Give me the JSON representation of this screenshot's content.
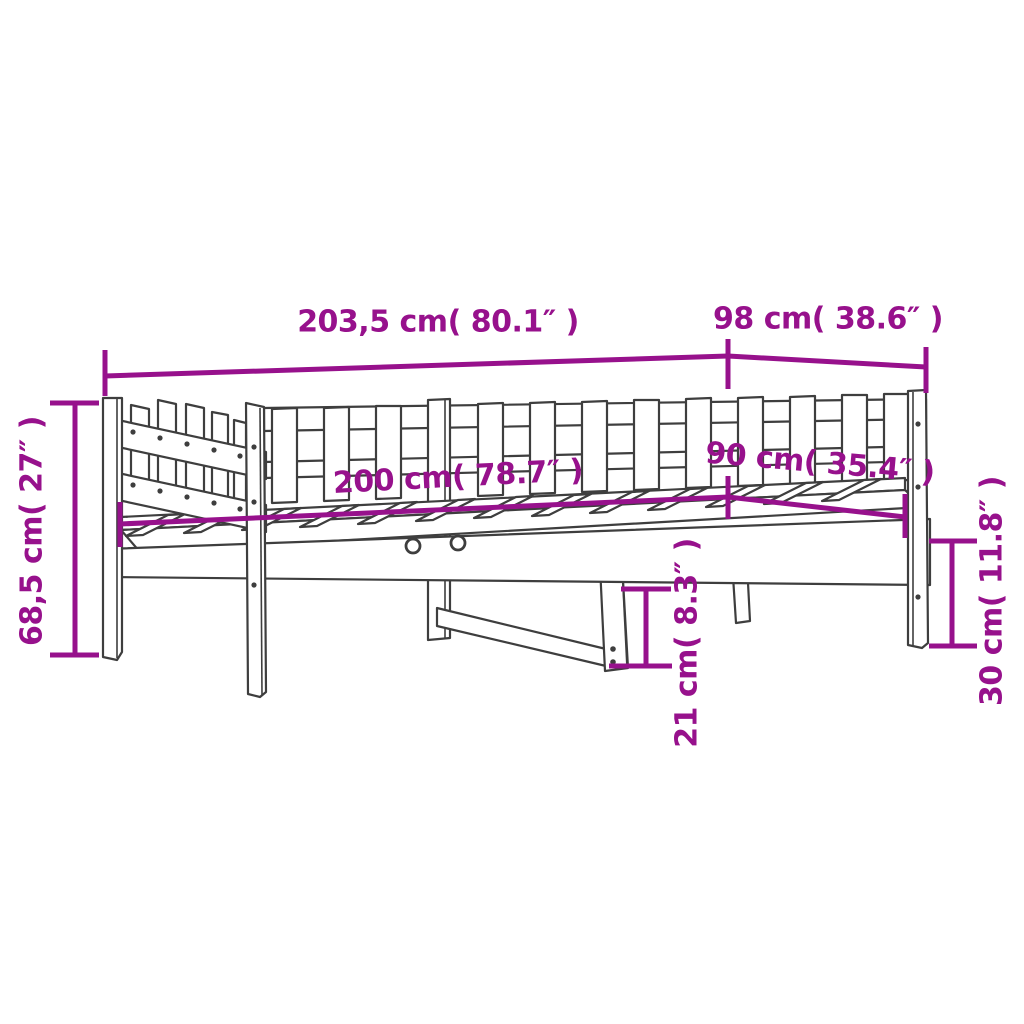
{
  "diagram_type": "product-dimension-diagram",
  "subject": "day-bed line drawing",
  "colors": {
    "dimension": "#97118C",
    "outline": "#3E3E3E",
    "background": "#FFFFFF"
  },
  "dimensions": [
    {
      "id": "total-length",
      "text": "203,5 cm( 80.1″ )"
    },
    {
      "id": "total-width",
      "text": "98 cm( 38.6″ )"
    },
    {
      "id": "total-height",
      "text": "68,5 cm( 27″ )"
    },
    {
      "id": "sleeping-length",
      "text": "200 cm( 78.7″ )"
    },
    {
      "id": "sleeping-width",
      "text": "90 cm( 35.4″ )"
    },
    {
      "id": "leg-height",
      "text": "30 cm( 11.8″ )"
    },
    {
      "id": "clearance-height",
      "text": "21 cm( 8.3″ )"
    }
  ]
}
